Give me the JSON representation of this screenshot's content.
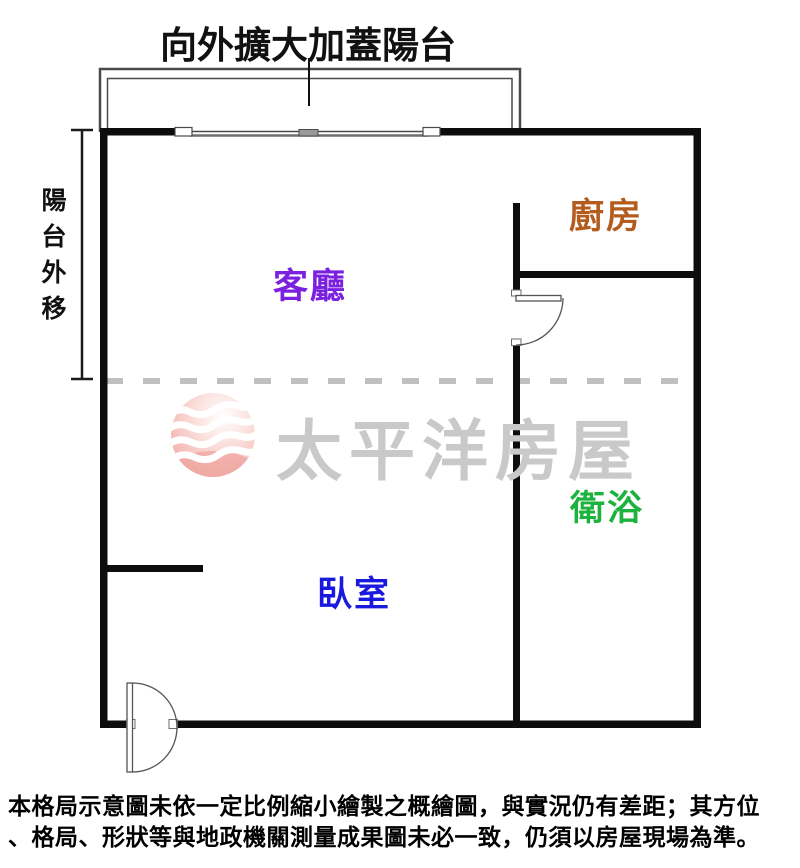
{
  "annotations": {
    "top_note": "向外擴大加蓋陽台",
    "side_note": "陽台外移"
  },
  "rooms": [
    {
      "id": "living",
      "label": "客廳",
      "color": "#7B1FE0"
    },
    {
      "id": "kitchen",
      "label": "廚房",
      "color": "#B35C1E"
    },
    {
      "id": "bath",
      "label": "衛浴",
      "color": "#1CB23E"
    },
    {
      "id": "bedroom",
      "label": "臥室",
      "color": "#1A1ADF"
    }
  ],
  "watermark": {
    "brand": "太平洋房屋",
    "text_color": "#C9C9C9",
    "logo_colors": {
      "sphere_light": "#FBE4E1",
      "sphere_deep": "#EFA9A4",
      "waves": "#FFFFFF"
    }
  },
  "disclaimer": {
    "line1": "本格局示意圖未依一定比例縮小繪製之概繪圖，與實況仍有差距；其方位",
    "line2": "、格局、形狀等與地政機關測量成果圖未必一致，仍須以房屋現場為準。"
  },
  "drawing_colors": {
    "wall": "#0D0D0D",
    "thin_line": "#4A4A4A",
    "dashed_split_line": "#C0C0C0"
  }
}
